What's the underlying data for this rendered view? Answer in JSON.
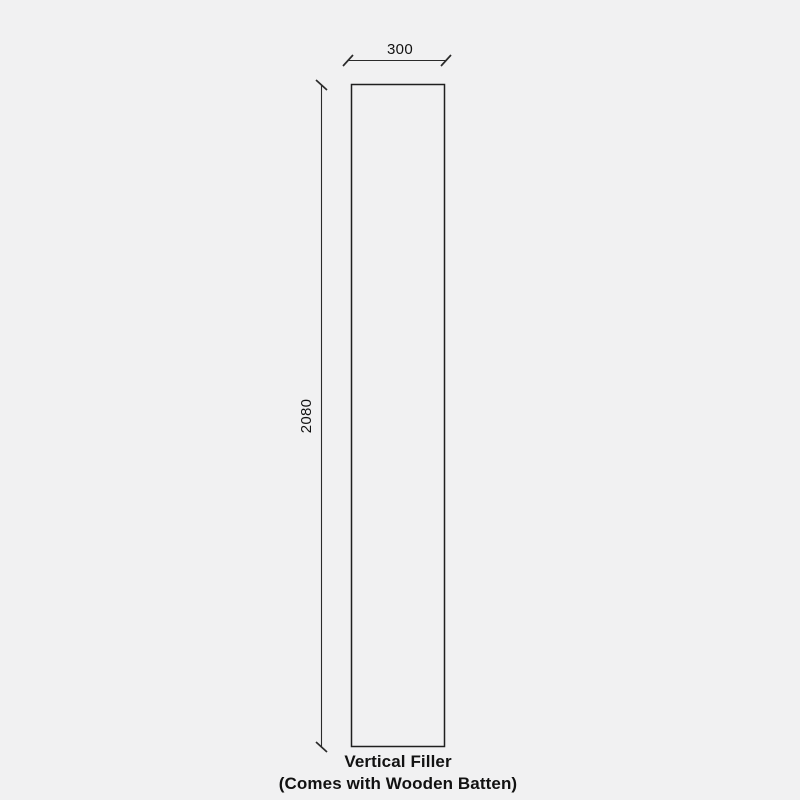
{
  "diagram": {
    "type": "dimensioned-technical-drawing",
    "dimensions": {
      "width": "300",
      "height": "2080"
    },
    "caption": {
      "line1": "Vertical Filler",
      "line2": "(Comes with Wooden Batten)"
    },
    "colors": {
      "background": "#f1f1f2",
      "outline": "#1f1f1f",
      "dimension_line": "#2b2b2b",
      "text": "#121212"
    }
  }
}
